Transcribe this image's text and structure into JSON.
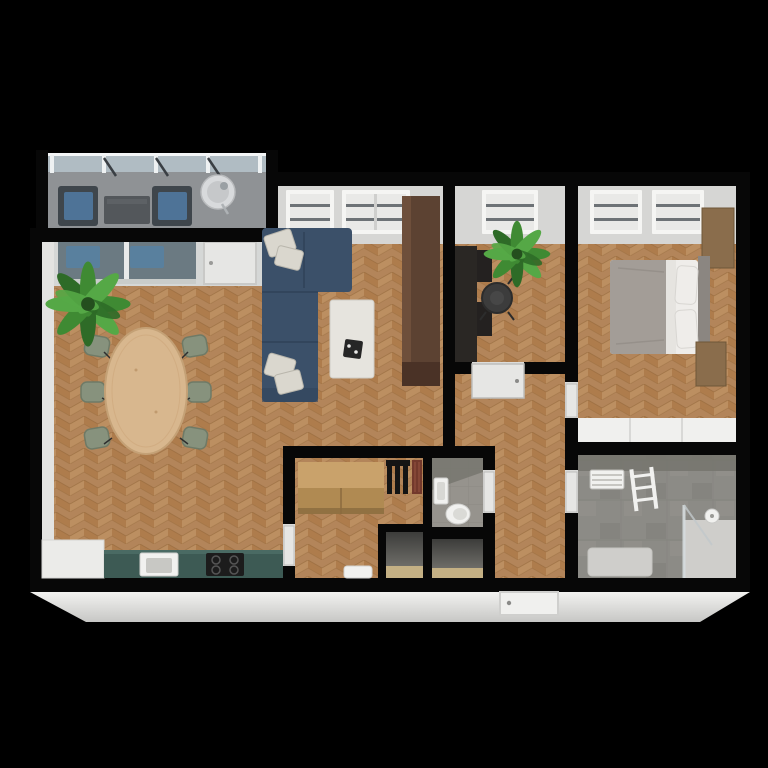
{
  "scene": {
    "description": "Top-down 3D render of an apartment floor plan on a black background",
    "style": "photorealistic 3D floor plan, bird's-eye view"
  },
  "colors": {
    "background": "#000000",
    "wall": "#070707",
    "wall_inner": "#d6d6d4",
    "wall_face_light": "#ebebe9",
    "floor_wood": "#b3855a",
    "floor_wood_dark": "#a9743f",
    "floor_wood_light": "#c29665",
    "floor_wood_line": "#8f6436",
    "balcony_floor": "#8f9295",
    "railing_glass": "#b9c6cd",
    "railing_post": "#eef1f2",
    "glass_door": "#6b7a82",
    "glass_reflection": "#5681a3",
    "door_leaf": "#e6e6e4",
    "window_frame": "#f5f5f3",
    "window_glazing": "#e9e9e7",
    "window_bar": "#6d7276",
    "sofa": "#3b5069",
    "sofa_dark": "#32455c",
    "pillow": "#dad7ce",
    "coffee_table": "#e6e4de",
    "tray_black": "#262626",
    "dining_table": "#d8b78e",
    "dining_table_edge": "#c4a176",
    "dining_chair": "#87927d",
    "plant_dark": "#2e6b27",
    "plant_mid": "#3f8a33",
    "plant_light": "#55a846",
    "wardrobe": "#5c4232",
    "wardrobe_light": "#6e4f3b",
    "desk": "#2a2724",
    "office_chair": "#3c3c3c",
    "bed_duvet": "#a39d97",
    "bed_linen": "#efedea",
    "headboard": "#8b8681",
    "nightstand_wood": "#8a6d4c",
    "built_in_wardrobe": "#f0f0ee",
    "bath_concrete": "#8c8b86",
    "bath_wall_shade": "#77756f",
    "shower_tray": "#cfcecb",
    "shower_glass": "#d6dcde",
    "fixture_white": "#f1f1ef",
    "kitchen_counter": "#3d5a54",
    "cooktop": "#1c1c1c",
    "sideboard_wood": "#c9a26b",
    "sideboard_wood_dark": "#b08a52",
    "radiator_red": "#73392c",
    "coat_rack": "#141414",
    "closet_floor": "#c4b084",
    "wc_tile": "#96938d",
    "balcony_chair": "#3f464c",
    "balcony_cushion": "#4e7397",
    "balcony_table": "#53575b",
    "bistro_table": "#d8dadc"
  },
  "apartment": {
    "rooms": [
      {
        "id": "balcony",
        "name": "Balcony",
        "items": [
          "glass railing",
          "lounge chair with blue cushion",
          "lounge chair with blue cushion",
          "outdoor coffee table",
          "round bistro table"
        ]
      },
      {
        "id": "living-room",
        "name": "Living room",
        "items": [
          "navy corner sofa",
          "white throw pillows",
          "white coffee table with black tray",
          "dark walnut wardrobe",
          "sliding glass balcony door",
          "balcony door",
          "two windows"
        ]
      },
      {
        "id": "dining-area",
        "name": "Dining area",
        "items": [
          "oval light-wood table",
          "six sage-green chairs",
          "potted palm"
        ]
      },
      {
        "id": "kitchen",
        "name": "Kitchen",
        "items": [
          "teal counter",
          "white sink",
          "black cooktop",
          "white tall cabinet"
        ]
      },
      {
        "id": "office",
        "name": "Home office",
        "items": [
          "dark desk",
          "black office chair",
          "potted palm",
          "window"
        ]
      },
      {
        "id": "bedroom",
        "name": "Bedroom",
        "items": [
          "double bed with grey duvet",
          "white pillows",
          "headboard",
          "wood wardrobe unit",
          "wood nightstand",
          "white built-in closet",
          "two windows"
        ]
      },
      {
        "id": "bathroom",
        "name": "Bathroom",
        "items": [
          "concrete floor",
          "towel radiator",
          "white ladder shelf",
          "walk-in shower with glass panel",
          "bathtub"
        ]
      },
      {
        "id": "wc",
        "name": "WC",
        "items": [
          "toilet",
          "washbasin"
        ]
      },
      {
        "id": "storage",
        "name": "Storage room",
        "items": [
          "wood sideboard",
          "black coat rack",
          "dark-red radiator",
          "white step"
        ]
      },
      {
        "id": "hallway",
        "name": "Hallway",
        "items": [
          "entrance door"
        ]
      },
      {
        "id": "closet-1",
        "name": "Closet",
        "items": []
      },
      {
        "id": "closet-2",
        "name": "Closet",
        "items": []
      }
    ]
  }
}
